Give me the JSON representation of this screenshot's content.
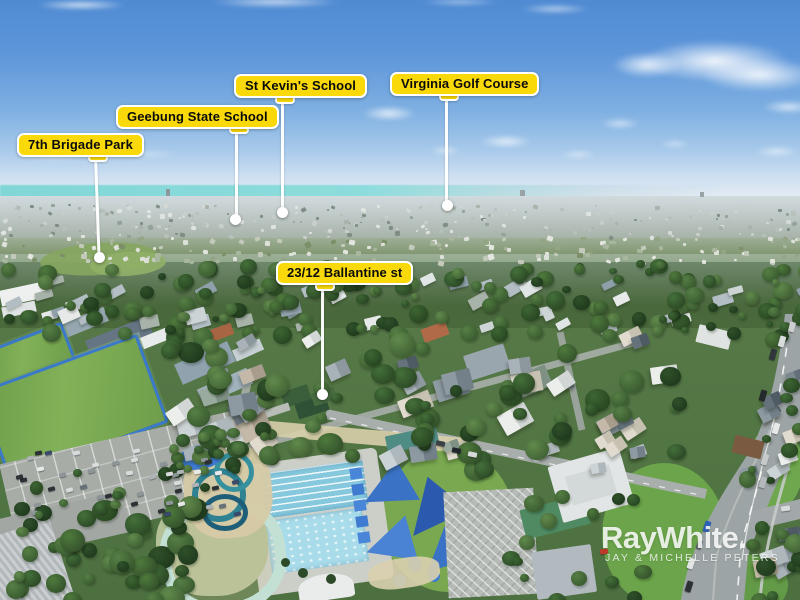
{
  "annotations": [
    {
      "id": "7th-brigade-park",
      "text": "7th Brigade Park"
    },
    {
      "id": "geebung-state-school",
      "text": "Geebung State School"
    },
    {
      "id": "st-kevins-school",
      "text": "St Kevin's School"
    },
    {
      "id": "virginia-golf-course",
      "text": "Virginia Golf Course"
    },
    {
      "id": "property-address",
      "text": "23/12 Ballantine st"
    }
  ],
  "watermark": {
    "brand": "RayWhite.",
    "agents": "JAY & MICHELLE PETERS"
  },
  "colors": {
    "label_background": "#F9D90A",
    "label_text": "#0B0B0B",
    "label_border": "#FFFFFF",
    "pointer_line": "#FFFFFF",
    "watermark_text": "#FFFFFF",
    "sky_top": "#4F8AD2",
    "bay_water": "#7CD5D4",
    "pool_water": "#86C8DD"
  }
}
